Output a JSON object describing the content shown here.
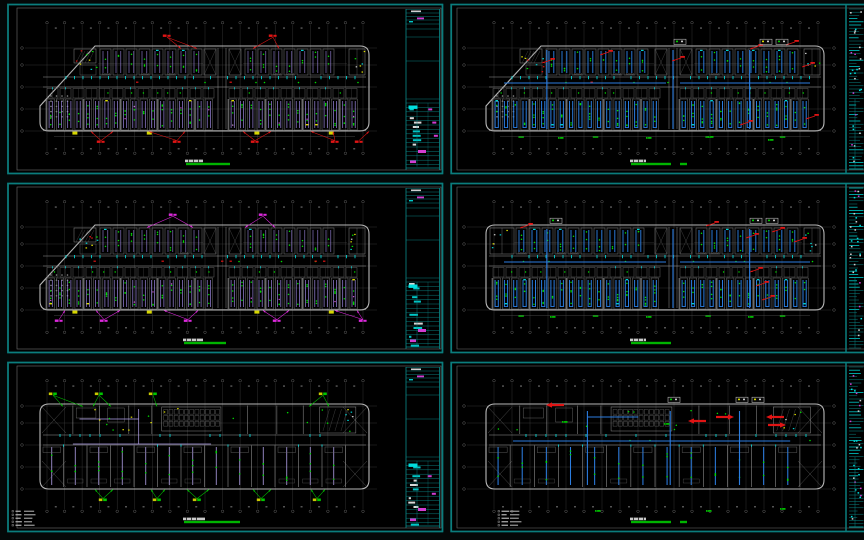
{
  "workspace": {
    "sheet_count": 6,
    "columns": 2,
    "rows": 3
  },
  "colors": {
    "page_bg": "#040808",
    "panel_bg": "#000000",
    "panel_border": "#0b7d7d",
    "sheet_frame": "#6f6f6f",
    "grid": "#383838",
    "wall": "#b8b8b8",
    "detail": "#8a8a8a",
    "dot_green": "#00dc00",
    "tick_cyan": "#00dcdc",
    "accent_yellow": "#dcdc00",
    "leader_red": "#e01414",
    "leader_magenta": "#dc28dc",
    "leader_green": "#00c000",
    "wire_purple": "#9c86e0",
    "wire_blue": "#2b7de0",
    "wire_lavender": "#b2a2ea",
    "caption_green": "#00b400",
    "titleblock_cyan": "#0b8b8b",
    "titleblock_cyan_bright": "#00c8c8",
    "titleblock_magenta": "#d23cd2",
    "text_light": "#c9c9c9"
  },
  "panels": [
    {
      "id": "sheet-1",
      "x": 7,
      "y": 3,
      "w": 437,
      "variant": "market",
      "wire": "purple",
      "diagonal_left": true,
      "titleblock": "full",
      "seed": 11,
      "leaders": {
        "color": "red",
        "top": [
          {
            "x": 160,
            "arms": [
              14,
              30
            ]
          },
          {
            "x": 266,
            "arms": [
              -20,
              6
            ]
          }
        ],
        "bottom": [
          {
            "x": 94,
            "arms": [
              -10,
              12
            ]
          },
          {
            "x": 170,
            "arms": [
              -28,
              8
            ]
          },
          {
            "x": 248,
            "arms": [
              -12,
              16
            ]
          },
          {
            "x": 328,
            "arms": [
              -24,
              -2
            ]
          },
          {
            "x": 352,
            "arms": [
              10
            ]
          }
        ]
      },
      "caption": {
        "x": 178,
        "tw": 18,
        "bw": 44,
        "extra": false
      }
    },
    {
      "id": "sheet-2",
      "x": 450,
      "y": 3,
      "w": 414,
      "variant": "market",
      "wire": "blue",
      "diagonal_left": true,
      "titleblock": "cut",
      "seed": 22,
      "red_marks": [
        {
          "x": 92,
          "y": 60
        },
        {
          "x": 150,
          "y": 52
        },
        {
          "x": 222,
          "y": 58
        },
        {
          "x": 300,
          "y": 46
        },
        {
          "x": 336,
          "y": 42
        },
        {
          "x": 352,
          "y": 64
        },
        {
          "x": 290,
          "y": 122
        },
        {
          "x": 356,
          "y": 116
        }
      ],
      "green_labels": [
        [
          108,
          134
        ],
        [
          196,
          134
        ],
        [
          258,
          133
        ],
        [
          318,
          136
        ]
      ],
      "top_boxes": [
        224,
        310,
        326
      ],
      "caption": {
        "x": 180,
        "tw": 16,
        "bw": 40,
        "extra": true
      }
    },
    {
      "id": "sheet-3",
      "x": 7,
      "y": 182,
      "w": 437,
      "variant": "market",
      "wire": "purple",
      "diagonal_left": true,
      "titleblock": "full",
      "seed": 33,
      "leaders": {
        "color": "magenta",
        "top": [
          {
            "x": 166,
            "arms": [
              -26,
              20
            ]
          },
          {
            "x": 256,
            "arms": [
              -18,
              12
            ]
          }
        ],
        "bottom": [
          {
            "x": 52,
            "arms": [
              6
            ]
          },
          {
            "x": 97,
            "arms": [
              -8,
              16
            ]
          },
          {
            "x": 181,
            "arms": [
              -24,
              10
            ]
          },
          {
            "x": 270,
            "arms": [
              -14,
              12
            ]
          },
          {
            "x": 356,
            "arms": [
              -28,
              -6
            ]
          }
        ]
      },
      "caption": {
        "x": 176,
        "tw": 20,
        "bw": 42,
        "extra": false
      }
    },
    {
      "id": "sheet-4",
      "x": 450,
      "y": 182,
      "w": 414,
      "variant": "market",
      "wire": "blue",
      "diagonal_left": false,
      "titleblock": "cut",
      "seed": 44,
      "red_marks": [
        {
          "x": 70,
          "y": 46
        },
        {
          "x": 256,
          "y": 44
        },
        {
          "x": 322,
          "y": 50
        },
        {
          "x": 344,
          "y": 60
        },
        {
          "x": 296,
          "y": 56
        },
        {
          "x": 300,
          "y": 90
        },
        {
          "x": 306,
          "y": 104
        },
        {
          "x": 312,
          "y": 118
        }
      ],
      "green_labels": [
        [
          100,
          134
        ],
        [
          196,
          134
        ],
        [
          298,
          134
        ]
      ],
      "top_boxes": [
        100,
        300,
        316
      ],
      "caption": {
        "x": 180,
        "tw": 16,
        "bw": 40,
        "extra": false
      }
    },
    {
      "id": "sheet-5",
      "x": 7,
      "y": 361,
      "w": 437,
      "variant": "basement",
      "wire": "lavender",
      "diagonal_left": false,
      "titleblock": "full",
      "seed": 55,
      "leaders": {
        "color": "green",
        "top": [
          {
            "x": 46,
            "arms": [
              10,
              30
            ]
          },
          {
            "x": 92,
            "arms": [
              -6,
              12
            ]
          },
          {
            "x": 146,
            "arms": [
              4
            ]
          },
          {
            "x": 316,
            "arms": [
              -14,
              6
            ]
          }
        ],
        "bottom": [
          {
            "x": 96,
            "arms": [
              -8,
              10
            ]
          },
          {
            "x": 150,
            "arms": [
              -6,
              8
            ]
          },
          {
            "x": 190,
            "arms": [
              -10,
              12
            ]
          },
          {
            "x": 254,
            "arms": [
              -8,
              10
            ]
          },
          {
            "x": 310,
            "arms": [
              -6,
              8
            ]
          }
        ]
      },
      "legend": {
        "x": 5,
        "y": 149.5
      },
      "caption": {
        "x": 176,
        "tw": 22,
        "bw": 56,
        "extra": false
      }
    },
    {
      "id": "sheet-6",
      "x": 450,
      "y": 361,
      "w": 414,
      "variant": "basement",
      "wire": "blue",
      "diagonal_left": false,
      "titleblock": "cut",
      "seed": 66,
      "bold_arrows": [
        {
          "x": 96,
          "y": 44,
          "d": 1
        },
        {
          "x": 238,
          "y": 60,
          "d": 1
        },
        {
          "x": 284,
          "y": 56,
          "d": -1
        },
        {
          "x": 316,
          "y": 56,
          "d": 1
        },
        {
          "x": 336,
          "y": 64,
          "d": -1
        }
      ],
      "green_labels": [
        [
          145,
          149
        ],
        [
          256,
          149
        ],
        [
          330,
          147
        ],
        [
          112,
          60
        ],
        [
          214,
          62
        ]
      ],
      "top_boxes": [
        218,
        286,
        302
      ],
      "legend": {
        "x": 48,
        "y": 149.5
      },
      "caption": {
        "x": 180,
        "tw": 16,
        "bw": 40,
        "extra": true
      }
    }
  ]
}
